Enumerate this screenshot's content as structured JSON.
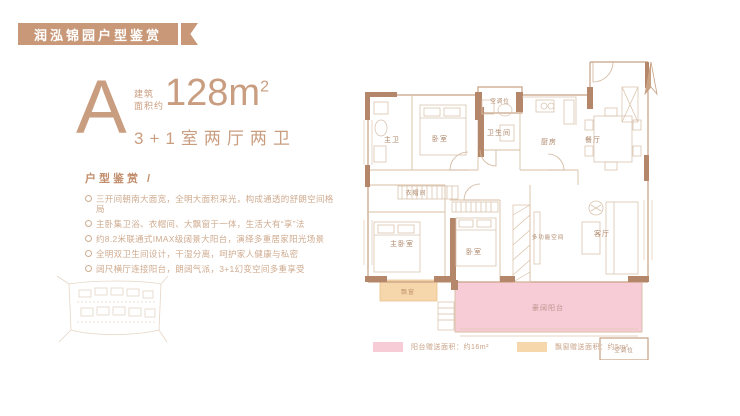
{
  "banner": {
    "title": "润泓锦园户型鉴赏"
  },
  "unit": {
    "letter": "A",
    "area_label_line1": "建筑",
    "area_label_line2": "面积约",
    "area_value": "128m",
    "area_exponent": "2",
    "rooms_line": "3+1室两厅两卫"
  },
  "features": {
    "heading": "户型鉴赏 /",
    "items": [
      "三开间朝南大面宽，全明大面积采光，构成通透的舒朗空间格局",
      "主卧集卫浴、衣帽间、大飘窗于一体，生活大有“享”法",
      "约8.2米联通式IMAX级阔景大阳台，演绎多重居家阳光场景",
      "全明双卫生间设计，干湿分离，呵护家人健康与私密",
      "阔尺横厅连接阳台，朗阔气派，3+1幻变空间多重享受"
    ]
  },
  "floorplan": {
    "rooms": {
      "master_bath": "主卫",
      "bedroom_north": "卧室",
      "bathroom": "卫生间",
      "kitchen": "厨房",
      "dining": "餐厅",
      "cloakroom": "衣帽间",
      "master_bedroom": "主卧室",
      "bedroom_south": "卧室",
      "living": "客厅",
      "flex_space": "多功能空间",
      "balcony": "豪阔阳台",
      "bay_window": "飘窗",
      "ac_top": "空调位",
      "ac_bottom": "空调位"
    },
    "legend": [
      {
        "color": "#f7ccd6",
        "label": "阳台赠送面积：约16m²"
      },
      {
        "color": "#f6d6ab",
        "label": "飘窗赠送面积：约5m²"
      }
    ]
  },
  "colors": {
    "accent": "#c89878",
    "wall_thick": "#b5876a",
    "wall_thin": "#c8a183",
    "balcony_pink": "#f7ccd6",
    "bay_orange": "#f6d6ab"
  }
}
